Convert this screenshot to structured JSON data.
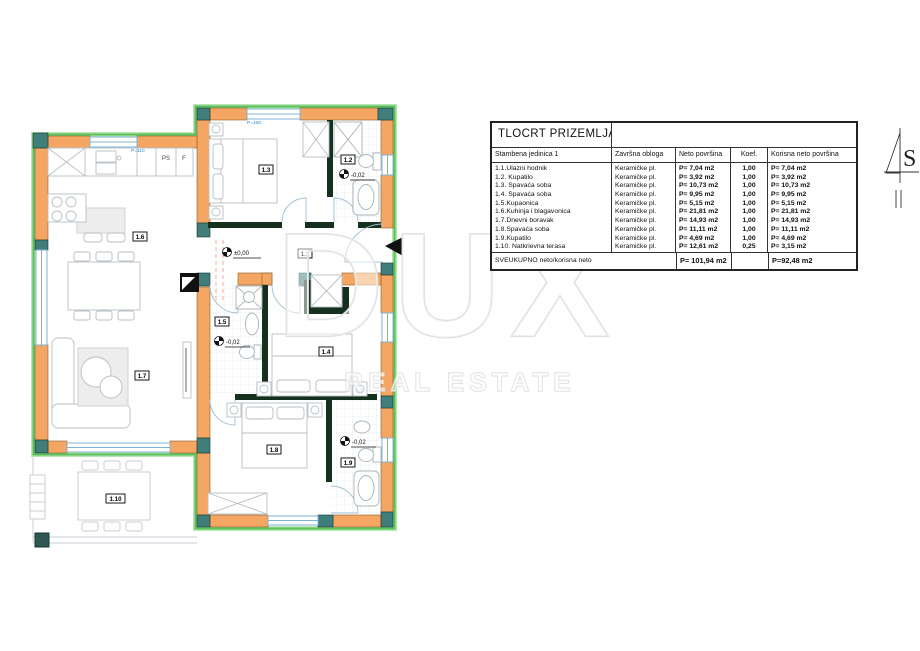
{
  "table": {
    "title": "TLOCRT PRIZEMLJA",
    "columns": [
      "Stambena jedinica 1",
      "Završna obloga",
      "Neto površina",
      "Koef.",
      "Korisna neto površina"
    ],
    "rows": [
      [
        "1.1.Ulazni hodnik",
        "Keramičke pl.",
        "P= 7,04 m2",
        "1,00",
        "P= 7,04 m2"
      ],
      [
        "1.2. Kupatilo",
        "Keramičke pl.",
        "P= 3,92 m2",
        "1,00",
        "P= 3,92 m2"
      ],
      [
        "1.3. Spavaća soba",
        "Keramičke pl.",
        "P= 10,73 m2",
        "1,00",
        "P= 10,73 m2"
      ],
      [
        "1.4. Spavaća soba",
        "Keramičke pl.",
        "P= 9,95 m2",
        "1,00",
        "P= 9,95 m2"
      ],
      [
        "1.5.Kupaonica",
        "Keramičke pl.",
        "P= 5,15 m2",
        "1,00",
        "P= 5,15 m2"
      ],
      [
        "1.6.Kuhinja i blagavonica",
        "Keramičke pl.",
        "P= 21,81 m2",
        "1,00",
        "P= 21,81 m2"
      ],
      [
        "1.7.Dnevni boravak",
        "Keramičke pl.",
        "P= 14,93 m2",
        "1,00",
        "P= 14,93 m2"
      ],
      [
        "1.8.Spavaća soba",
        "Keramičke pl.",
        "P= 11,11 m2",
        "1,00",
        "P= 11,11 m2"
      ],
      [
        "1.9.Kupatilo",
        "Keramičke pl.",
        "P= 4,69 m2",
        "1,00",
        "P= 4,69 m2"
      ],
      [
        "1.10. Natkrievna terasa",
        "Keramičke pl.",
        "P= 12,61 m2",
        "0,25",
        "P= 3,15 m2"
      ]
    ],
    "total": {
      "label": "SVEUKUPNO neto/korisna neto",
      "net": "P= 101,94 m2",
      "useful": "P=92,48 m2"
    }
  },
  "plan": {
    "rooms": {
      "r1_1": "1.1",
      "r1_2": "1.2",
      "r1_3": "1.3",
      "r1_4": "1.4",
      "r1_5": "1.5",
      "r1_6": "1.6",
      "r1_7": "1.7",
      "r1_8": "1.8",
      "r1_9": "1.9",
      "r1_10": "1.10"
    },
    "levels": {
      "hallway": "±0,00",
      "bath_1_2": "-0,02",
      "bath_1_5": "-0,02",
      "bath_1_9": "-0,02"
    },
    "notes": {
      "ps": "PS",
      "f": "F",
      "parapet_kitchen": "P=110",
      "parapet_bedroom": "P=100"
    },
    "north": "S"
  },
  "watermark": {
    "line1": "DUX",
    "line2": "REAL ESTATE"
  },
  "colors": {
    "wall_fill": "#f4a662",
    "post_fill": "#3f7e7a",
    "insulation": "#58c158",
    "interior_wall": "#15301d",
    "window": "#7fb3d5",
    "annotation_blue": "#2f86c8"
  }
}
